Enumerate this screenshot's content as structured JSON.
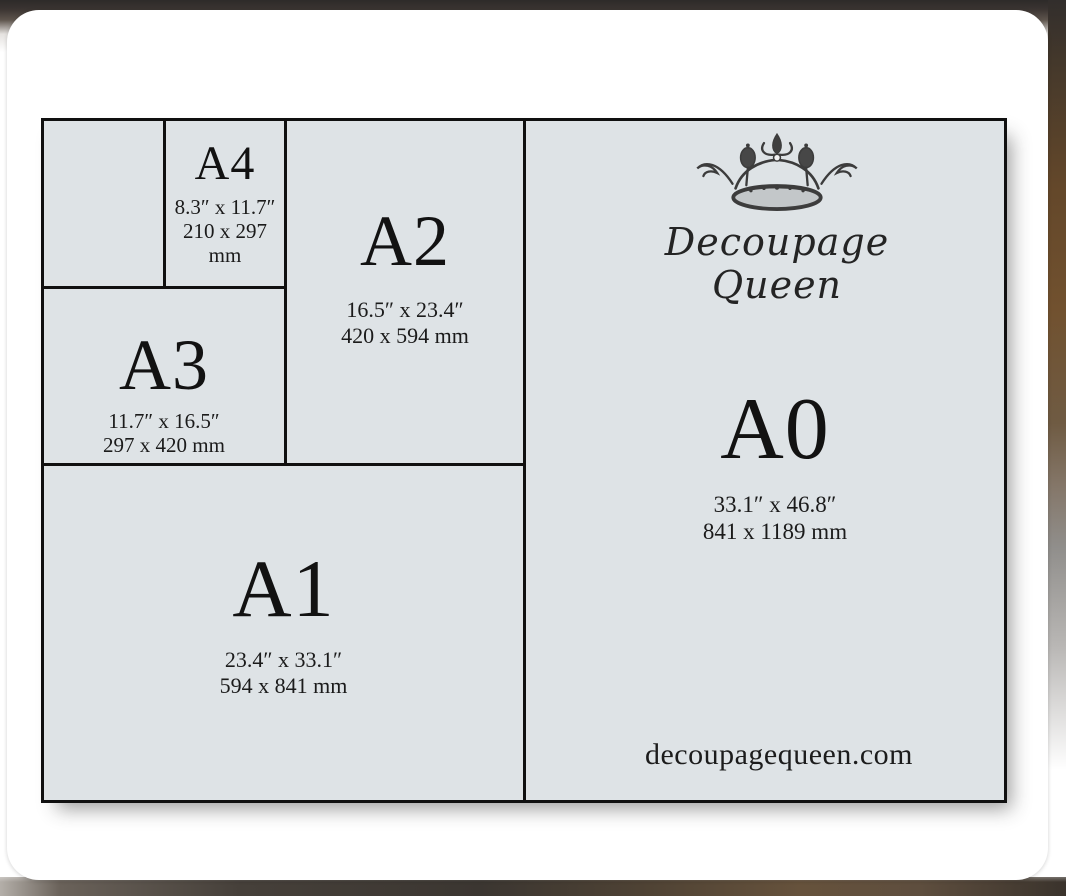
{
  "colors": {
    "diagram_bg": "#dee3e6",
    "line_color": "#101010",
    "card_bg": "#ffffff",
    "text_color": "#141414"
  },
  "brand": {
    "line1": "Decoupage",
    "line2": "Queen",
    "website": "decoupagequeen.com",
    "crown_icon": "crown-icon"
  },
  "sizes": [
    {
      "label": "A4",
      "inches": "8.3″ x 11.7″",
      "mm": "210 x 297 mm"
    },
    {
      "label": "A3",
      "inches": "11.7″ x 16.5″",
      "mm": "297 x 420 mm"
    },
    {
      "label": "A2",
      "inches": "16.5″ x 23.4″",
      "mm": "420 x 594 mm"
    },
    {
      "label": "A1",
      "inches": "23.4″ x 33.1″",
      "mm": "594 x 841 mm"
    },
    {
      "label": "A0",
      "inches": "33.1″ x 46.8″",
      "mm": "841 x 1189 mm"
    }
  ]
}
